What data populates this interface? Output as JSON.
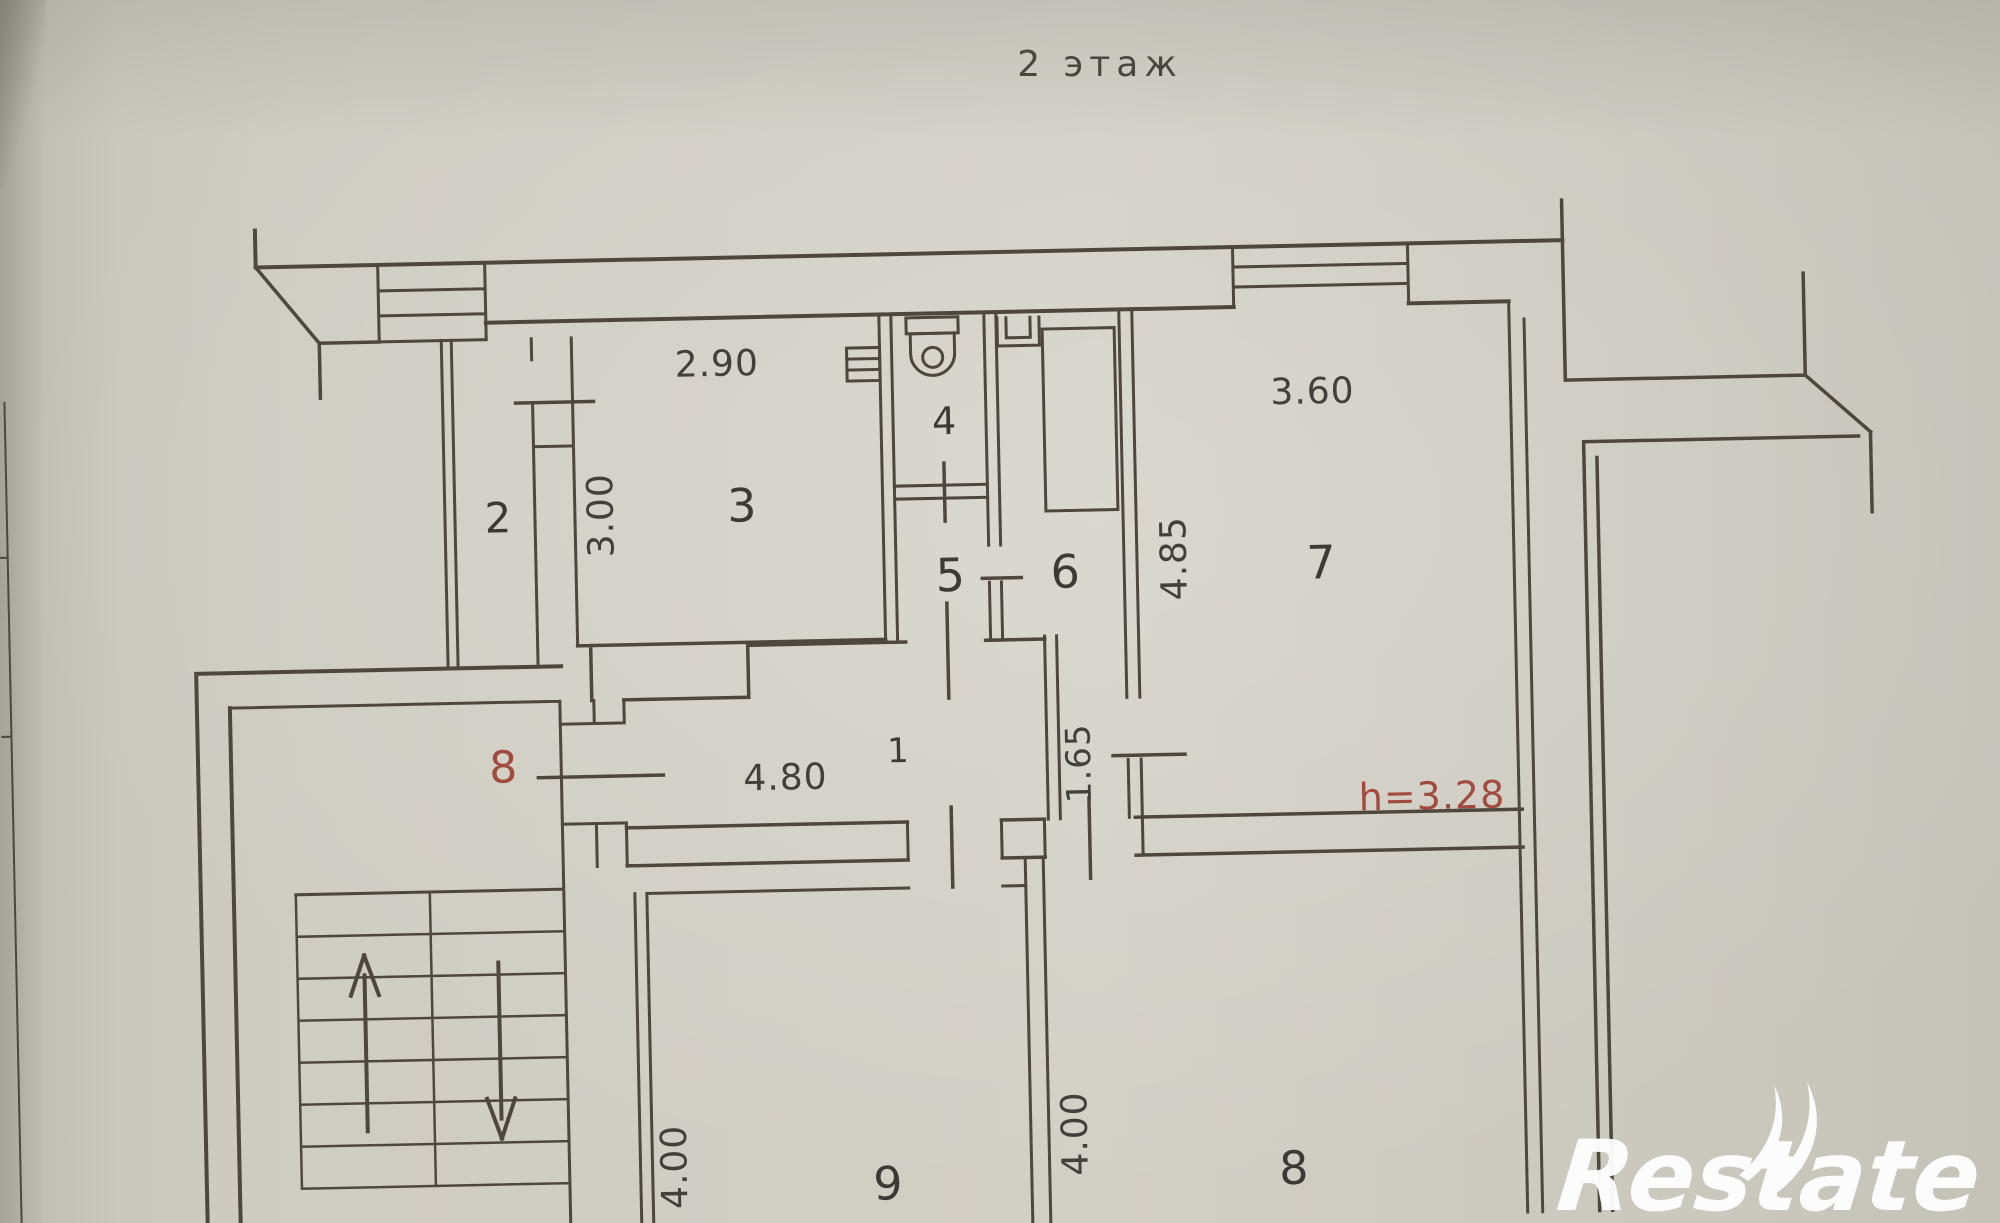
{
  "document": {
    "kind": "scanned floor plan photo",
    "floor_title": "2 этаж"
  },
  "colors": {
    "paper": "#cfccc2",
    "ink": "#4e473e",
    "label_text": "#3b3a35",
    "red_annotation": "#a14b3e",
    "watermark": "#ffffff"
  },
  "rooms": [
    {
      "id": "hallway",
      "label": "1"
    },
    {
      "id": "closet",
      "label": "2"
    },
    {
      "id": "room-3",
      "label": "3"
    },
    {
      "id": "wc",
      "label": "4"
    },
    {
      "id": "room-5",
      "label": "5"
    },
    {
      "id": "room-6",
      "label": "6"
    },
    {
      "id": "room-7",
      "label": "7"
    },
    {
      "id": "room-8",
      "label": "8"
    },
    {
      "id": "room-9",
      "label": "9"
    }
  ],
  "dimensions": [
    {
      "id": "dim-290",
      "text": "2.90",
      "orientation": "horizontal"
    },
    {
      "id": "dim-300",
      "text": "3.00",
      "orientation": "vertical"
    },
    {
      "id": "dim-360",
      "text": "3.60",
      "orientation": "horizontal"
    },
    {
      "id": "dim-485",
      "text": "4.85",
      "orientation": "vertical"
    },
    {
      "id": "dim-480",
      "text": "4.80",
      "orientation": "horizontal"
    },
    {
      "id": "dim-165",
      "text": "1.65",
      "orientation": "vertical"
    },
    {
      "id": "dim-400-left",
      "text": "4.00",
      "orientation": "vertical"
    },
    {
      "id": "dim-400-right",
      "text": "4.00",
      "orientation": "vertical"
    }
  ],
  "annotations": {
    "apartment_number": "8",
    "ceiling_height": "h=3.28"
  },
  "stairs": {
    "up_arrow": "up",
    "down_arrow": "down"
  },
  "watermark": {
    "text": "Restate"
  }
}
